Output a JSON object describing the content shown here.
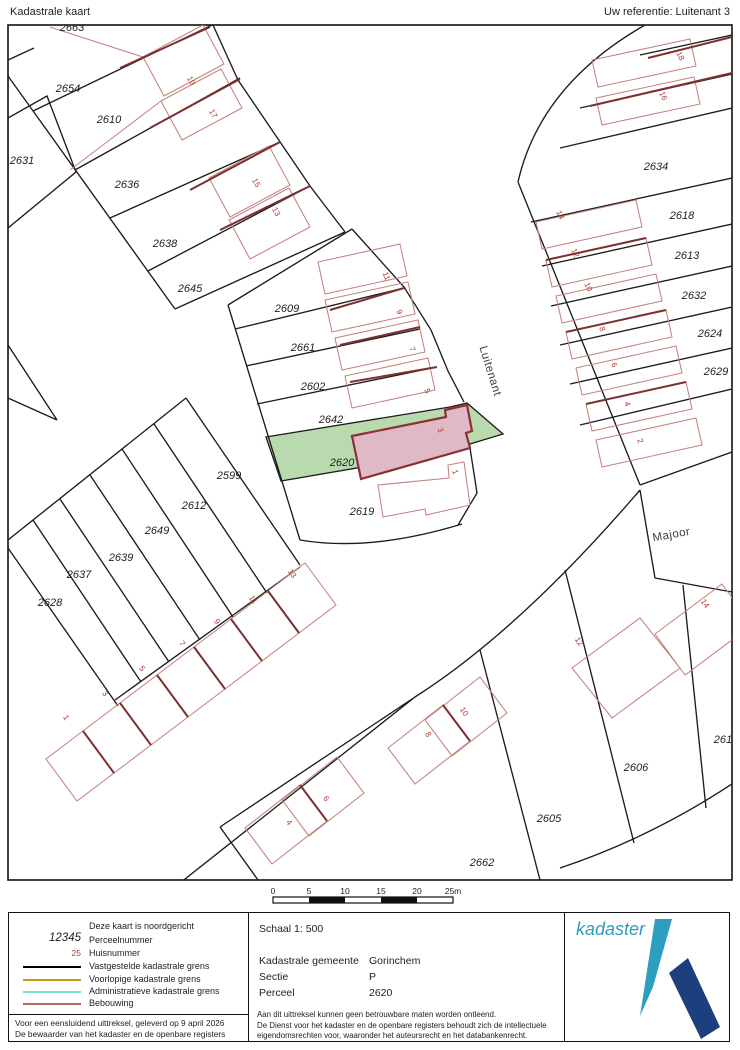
{
  "header": {
    "title": "Kadastrale kaart",
    "reference": "Uw referentie: Luitenant 3"
  },
  "colors": {
    "highlight_parcel": "#b9d9ae",
    "highlight_building": "#dfbac6",
    "selected_outline": "#8c2f36",
    "building_line": "#c4837d",
    "building_wall": "#7e2f2f",
    "boundary_line": "#1c1c1c",
    "logo_teal": "#2d9dc0",
    "logo_navy": "#1e3f7d"
  },
  "map": {
    "street_labels": [
      {
        "text": "Luitenant",
        "x": 487,
        "y": 372,
        "rot": 73
      },
      {
        "text": "Majoor",
        "x": 672,
        "y": 538,
        "rot": -10
      }
    ],
    "parcel_labels": [
      {
        "text": "2663",
        "x": 72,
        "y": 31
      },
      {
        "text": "2654",
        "x": 68,
        "y": 92
      },
      {
        "text": "2610",
        "x": 109,
        "y": 123
      },
      {
        "text": "2631",
        "x": 22,
        "y": 164
      },
      {
        "text": "2636",
        "x": 127,
        "y": 188
      },
      {
        "text": "2638",
        "x": 165,
        "y": 247
      },
      {
        "text": "2645",
        "x": 190,
        "y": 292
      },
      {
        "text": "2609",
        "x": 287,
        "y": 312
      },
      {
        "text": "2661",
        "x": 303,
        "y": 351
      },
      {
        "text": "2602",
        "x": 313,
        "y": 390
      },
      {
        "text": "2642",
        "x": 331,
        "y": 423
      },
      {
        "text": "2620",
        "x": 342,
        "y": 466
      },
      {
        "text": "2619",
        "x": 362,
        "y": 515
      },
      {
        "text": "2599",
        "x": 229,
        "y": 479
      },
      {
        "text": "2612",
        "x": 194,
        "y": 509
      },
      {
        "text": "2649",
        "x": 157,
        "y": 534
      },
      {
        "text": "2639",
        "x": 121,
        "y": 561
      },
      {
        "text": "2637",
        "x": 79,
        "y": 578
      },
      {
        "text": "2628",
        "x": 50,
        "y": 606
      },
      {
        "text": "2634",
        "x": 656,
        "y": 170
      },
      {
        "text": "2618",
        "x": 682,
        "y": 219
      },
      {
        "text": "2613",
        "x": 687,
        "y": 259
      },
      {
        "text": "2632",
        "x": 694,
        "y": 299
      },
      {
        "text": "2624",
        "x": 710,
        "y": 337
      },
      {
        "text": "2629",
        "x": 716,
        "y": 375
      },
      {
        "text": "2606",
        "x": 636,
        "y": 771
      },
      {
        "text": "2605",
        "x": 549,
        "y": 822
      },
      {
        "text": "2662",
        "x": 482,
        "y": 866
      },
      {
        "text": "2616",
        "x": 726,
        "y": 743
      }
    ],
    "house_numbers": [
      {
        "text": "19",
        "x": 189,
        "y": 82,
        "rot": 60
      },
      {
        "text": "17",
        "x": 211,
        "y": 115,
        "rot": 60
      },
      {
        "text": "15",
        "x": 254,
        "y": 184,
        "rot": 60
      },
      {
        "text": "13",
        "x": 274,
        "y": 213,
        "rot": 60
      },
      {
        "text": "11",
        "x": 384,
        "y": 277,
        "rot": 68
      },
      {
        "text": "9",
        "x": 397,
        "y": 313,
        "rot": 68
      },
      {
        "text": "7",
        "x": 410,
        "y": 350,
        "rot": 68
      },
      {
        "text": "5",
        "x": 425,
        "y": 392,
        "rot": 68
      },
      {
        "text": "3",
        "x": 438,
        "y": 431,
        "rot": 68
      },
      {
        "text": "1",
        "x": 453,
        "y": 473,
        "rot": 68
      },
      {
        "text": "13",
        "x": 290,
        "y": 575,
        "rot": 55
      },
      {
        "text": "11",
        "x": 251,
        "y": 601,
        "rot": 55
      },
      {
        "text": "9",
        "x": 215,
        "y": 623,
        "rot": 55
      },
      {
        "text": "7",
        "x": 180,
        "y": 645,
        "rot": 55
      },
      {
        "text": "5",
        "x": 140,
        "y": 670,
        "rot": 55
      },
      {
        "text": "3",
        "x": 103,
        "y": 695,
        "rot": 55
      },
      {
        "text": "1",
        "x": 64,
        "y": 719,
        "rot": 55
      },
      {
        "text": "18",
        "x": 678,
        "y": 57,
        "rot": 65
      },
      {
        "text": "16",
        "x": 661,
        "y": 97,
        "rot": 65
      },
      {
        "text": "14",
        "x": 558,
        "y": 216,
        "rot": 65
      },
      {
        "text": "12",
        "x": 573,
        "y": 254,
        "rot": 65
      },
      {
        "text": "10",
        "x": 586,
        "y": 288,
        "rot": 65
      },
      {
        "text": "8",
        "x": 600,
        "y": 330,
        "rot": 65
      },
      {
        "text": "6",
        "x": 612,
        "y": 366,
        "rot": 65
      },
      {
        "text": "4",
        "x": 625,
        "y": 405,
        "rot": 65
      },
      {
        "text": "2",
        "x": 638,
        "y": 442,
        "rot": 65
      },
      {
        "text": "14",
        "x": 703,
        "y": 605,
        "rot": 55
      },
      {
        "text": "12",
        "x": 577,
        "y": 643,
        "rot": 55
      },
      {
        "text": "10",
        "x": 462,
        "y": 713,
        "rot": 55
      },
      {
        "text": "8",
        "x": 426,
        "y": 736,
        "rot": 55
      },
      {
        "text": "6",
        "x": 324,
        "y": 800,
        "rot": 55
      },
      {
        "text": "4",
        "x": 287,
        "y": 824,
        "rot": 55
      }
    ]
  },
  "scalebar": {
    "labels": [
      {
        "text": "0",
        "x": 273
      },
      {
        "text": "5",
        "x": 309
      },
      {
        "text": "10",
        "x": 345
      },
      {
        "text": "15",
        "x": 381
      },
      {
        "text": "20",
        "x": 417
      },
      {
        "text": "25m",
        "x": 453
      }
    ]
  },
  "legend": {
    "north_note": "Deze kaart is noordgericht",
    "parcel_sample": "12345",
    "parcel_label": "Perceelnummer",
    "house_sample": "25",
    "house_label": "Huisnummer",
    "lines": [
      {
        "label": "Vastgestelde kadastrale grens",
        "color": "#000000"
      },
      {
        "label": "Voorlopige kadastrale grens",
        "color": "#c9971c"
      },
      {
        "label": "Administratieve kadastrale grens",
        "color": "#7de0dc"
      },
      {
        "label": "Bebouwing",
        "color": "#ad6a62"
      }
    ],
    "issued_line1": "Voor een eensluidend uittreksel, geleverd op 9 april 2026",
    "issued_line2": "De bewaarder van het kadaster en de openbare registers"
  },
  "details": {
    "schaal": "Schaal 1: 500",
    "rows": [
      {
        "label": "Kadastrale gemeente",
        "value": "Gorinchem"
      },
      {
        "label": "Sectie",
        "value": "P"
      },
      {
        "label": "Perceel",
        "value": "2620"
      }
    ],
    "disclaimer": [
      "Aan dit uittreksel kunnen geen betrouwbare maten worden ontleend.",
      "De Dienst voor het kadaster en de openbare registers behoudt zich de intellectuele",
      "eigendomsrechten voor, waaronder het auteursrecht en het databankenrecht."
    ]
  },
  "logo": {
    "text": "kadaster"
  }
}
